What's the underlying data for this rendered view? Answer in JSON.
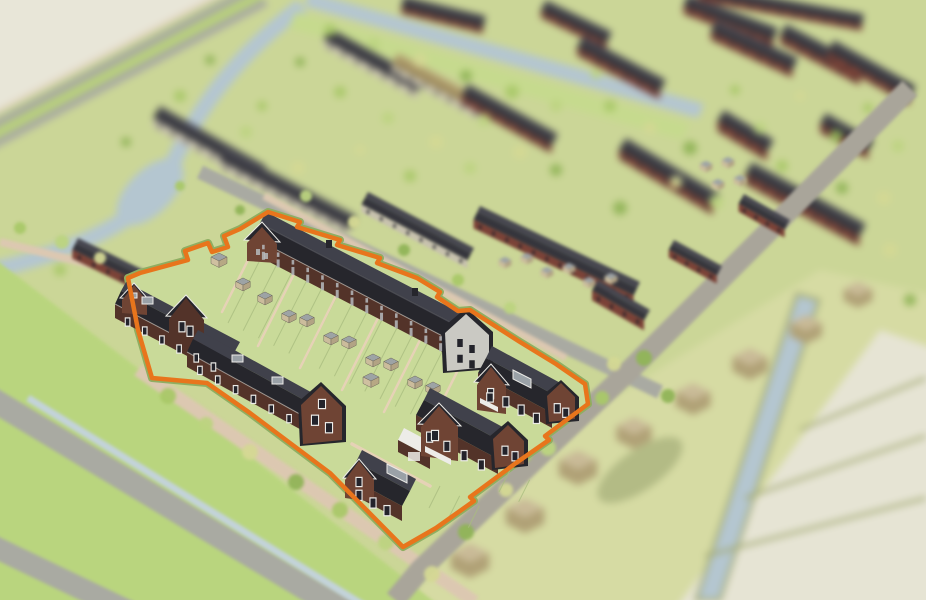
{
  "meta": {
    "title": "3D aerial visualisation of a new-build housing estate",
    "view": "isometric bird's-eye render, tilt-shift: background blurred, one building plot in focus",
    "highlight": "plot for sale outlined in orange containing terraced rows, garden sheds and detached houses"
  },
  "palette": {
    "base": "#cbd697",
    "beige": "#e8e6d8",
    "beigePolder": "#e6e4d4",
    "grassBright": "#b9d57e",
    "plotGrass": "#c9da99",
    "verge": "#b9d27b",
    "vergeDark": "#8fae62",
    "dike": "#c6da8e",
    "fieldYellow": "#d6dba3",
    "water": "#b4c6d0",
    "ditch": "#c3d3da",
    "road": "#a9aaa2",
    "roadWarm": "#a9a59a",
    "pathTan": "#dcc8b1",
    "pathPlot": "#e6d2b6",
    "orange": "#e8751c",
    "roofD": "#26262c",
    "roofL": "#40414b",
    "brick": "#533329",
    "brickB": "#6f4434",
    "stucco": "#cac9c3",
    "trim": "#edece8",
    "sky": "#9aa1a7",
    "skyD": "#737b83",
    "shedTop": "#9da3a5",
    "shedL": "#cbbc9c",
    "shedR": "#b2a384",
    "shedEdge": "#6f6a5c",
    "barn": "#c9ba97",
    "barnD": "#b0a176",
    "olive": "#a3aa74",
    "fence": "#a9bd7f",
    "win": "#23232b",
    "winL": "#b6babd",
    "shadow": "#7f8d57",
    "tree1": "#a9c868",
    "tree2": "#bcd480",
    "tree3": "#d4d894",
    "tree4": "#90b457"
  },
  "boundary": {
    "color_key": "orange",
    "stroke_width": 4.5,
    "verge_width": 8,
    "points": "268,212 300,222 297,227 340,240 337,245 380,258 377,263 417,278 440,292 437,297 458,311 470,310 520,342 556,364 585,384 588,404 545,436 549,440 516,463 470,497 474,501 436,528 403,547 330,473 250,413 207,383 152,378 138,330 128,278 140,273 188,260 185,251 208,243 212,252 228,247 224,236 240,229"
  },
  "background": {
    "rows_far": [
      [
        160,
        106,
        266,
        166,
        14,
        9,
        "light",
        "dark"
      ],
      [
        226,
        148,
        356,
        216,
        14,
        9,
        "light",
        "dark"
      ],
      [
        330,
        28,
        424,
        80,
        13,
        8,
        "light",
        "dark"
      ],
      [
        398,
        53,
        488,
        102,
        13,
        8,
        "light",
        "tanroof"
      ],
      [
        468,
        84,
        558,
        134,
        13,
        8,
        "brick",
        "dark"
      ],
      [
        404,
        -4,
        486,
        16,
        12,
        6,
        "brick",
        "dark"
      ],
      [
        546,
        0,
        612,
        32,
        12,
        7,
        "brick",
        "dark"
      ],
      [
        583,
        36,
        666,
        80,
        13,
        8,
        "brick",
        "dark"
      ],
      [
        688,
        -6,
        778,
        28,
        13,
        8,
        "brick",
        "dark"
      ],
      [
        716,
        20,
        798,
        58,
        13,
        8,
        "brick",
        "dark"
      ],
      [
        786,
        24,
        866,
        66,
        13,
        8,
        "brick",
        "dark"
      ],
      [
        834,
        40,
        916,
        86,
        13,
        8,
        "brick",
        "dark"
      ],
      [
        700,
        -16,
        864,
        14,
        11,
        6,
        "brick",
        "dark"
      ],
      [
        626,
        138,
        720,
        194,
        14,
        9,
        "brick",
        "dark"
      ],
      [
        724,
        110,
        774,
        140,
        13,
        10,
        "brick",
        "dark"
      ],
      [
        826,
        113,
        874,
        140,
        12,
        9,
        "brick",
        "dark"
      ],
      [
        752,
        162,
        866,
        224,
        14,
        10,
        "brick",
        "dark"
      ]
    ],
    "rows_near": [
      [
        368,
        192,
        474,
        248,
        14,
        8,
        "light",
        "dark"
      ],
      [
        480,
        206,
        640,
        282,
        15,
        9,
        "brick",
        "dark"
      ],
      [
        598,
        280,
        650,
        310,
        12,
        10,
        "brick",
        "dark"
      ],
      [
        674,
        240,
        722,
        266,
        11,
        8,
        "brick",
        "dark"
      ],
      [
        744,
        194,
        790,
        220,
        11,
        8,
        "brick",
        "dark"
      ],
      [
        78,
        238,
        178,
        287,
        13,
        9,
        "brick",
        "dark"
      ]
    ],
    "barns": [
      [
        470,
        565,
        24
      ],
      [
        525,
        520,
        24
      ],
      [
        578,
        472,
        24
      ],
      [
        634,
        437,
        22
      ],
      [
        693,
        403,
        22
      ],
      [
        750,
        368,
        22
      ],
      [
        806,
        333,
        20
      ],
      [
        858,
        298,
        18
      ]
    ],
    "bg_sheds": [
      [
        505,
        264
      ],
      [
        527,
        260
      ],
      [
        547,
        274
      ],
      [
        569,
        270
      ],
      [
        589,
        284
      ],
      [
        611,
        280
      ],
      [
        706,
        168
      ],
      [
        728,
        164
      ],
      [
        718,
        186
      ],
      [
        740,
        182
      ]
    ],
    "trees_far": [
      [
        180,
        96,
        6
      ],
      [
        246,
        132,
        6
      ],
      [
        298,
        168,
        7
      ],
      [
        126,
        142,
        5
      ],
      [
        340,
        92,
        6
      ],
      [
        388,
        118,
        6
      ],
      [
        436,
        142,
        7
      ],
      [
        300,
        62,
        5
      ],
      [
        262,
        106,
        5
      ],
      [
        484,
        120,
        6
      ],
      [
        520,
        152,
        7
      ],
      [
        556,
        170,
        6
      ],
      [
        610,
        106,
        6
      ],
      [
        596,
        74,
        5
      ],
      [
        650,
        128,
        6
      ],
      [
        690,
        148,
        7
      ],
      [
        735,
        90,
        5
      ],
      [
        760,
        128,
        6
      ],
      [
        800,
        96,
        5
      ],
      [
        836,
        136,
        6
      ],
      [
        868,
        108,
        5
      ],
      [
        898,
        146,
        6
      ],
      [
        884,
        198,
        7
      ],
      [
        842,
        188,
        6
      ],
      [
        782,
        166,
        6
      ],
      [
        716,
        202,
        7
      ],
      [
        676,
        182,
        6
      ],
      [
        620,
        208,
        7
      ],
      [
        410,
        176,
        6
      ],
      [
        470,
        168,
        6
      ],
      [
        360,
        150,
        5
      ],
      [
        210,
        60,
        5
      ],
      [
        60,
        270,
        6
      ],
      [
        30,
        320,
        5
      ],
      [
        890,
        250,
        7
      ],
      [
        910,
        300,
        6
      ],
      [
        330,
        30,
        6
      ],
      [
        374,
        44,
        6
      ],
      [
        420,
        60,
        7
      ],
      [
        466,
        76,
        6
      ],
      [
        512,
        92,
        7
      ],
      [
        556,
        106,
        6
      ]
    ],
    "trees_near": [
      [
        168,
        396,
        8
      ],
      [
        206,
        424,
        7
      ],
      [
        250,
        452,
        8
      ],
      [
        296,
        482,
        8
      ],
      [
        340,
        510,
        8
      ],
      [
        386,
        542,
        8
      ],
      [
        432,
        574,
        8
      ],
      [
        644,
        358,
        8
      ],
      [
        602,
        398,
        7
      ],
      [
        548,
        448,
        8
      ],
      [
        506,
        490,
        7
      ],
      [
        466,
        532,
        8
      ],
      [
        525,
        455,
        7
      ],
      [
        306,
        196,
        6
      ],
      [
        354,
        222,
        6
      ],
      [
        404,
        250,
        6
      ],
      [
        458,
        280,
        6
      ],
      [
        510,
        308,
        6
      ],
      [
        614,
        364,
        7
      ],
      [
        668,
        396,
        7
      ],
      [
        20,
        228,
        6
      ],
      [
        62,
        242,
        7
      ],
      [
        100,
        258,
        6
      ],
      [
        240,
        210,
        5
      ],
      [
        180,
        186,
        5
      ]
    ]
  },
  "plot": {
    "sheds": [
      [
        219,
        262,
        10,
        "tan"
      ],
      [
        243,
        286,
        9,
        "gray"
      ],
      [
        265,
        300,
        9,
        "gray"
      ],
      [
        289,
        318,
        9,
        "gray"
      ],
      [
        307,
        322,
        9,
        "gray"
      ],
      [
        331,
        340,
        9,
        "gray"
      ],
      [
        349,
        344,
        9,
        "gray"
      ],
      [
        373,
        362,
        9,
        "gray"
      ],
      [
        391,
        366,
        9,
        "gray"
      ],
      [
        415,
        384,
        9,
        "gray"
      ],
      [
        371,
        382,
        10,
        "tan"
      ],
      [
        433,
        390,
        9,
        "gray"
      ]
    ],
    "spur_paths": [
      [
        254,
        248,
        222,
        312
      ],
      [
        296,
        270,
        258,
        346
      ],
      [
        338,
        292,
        300,
        368
      ],
      [
        380,
        314,
        342,
        390
      ],
      [
        422,
        336,
        384,
        412
      ],
      [
        464,
        358,
        426,
        434
      ]
    ],
    "fences": [
      {
        "x": 264,
        "y": 252,
        "ux": 0.894,
        "uy": 0.447,
        "step": 17,
        "count": 13,
        "vx": -36,
        "vy": 71
      },
      {
        "x": 440,
        "y": 486,
        "ux": 0.894,
        "uy": 0.447,
        "step": 22,
        "count": 3,
        "vx": -11,
        "vy": 22
      },
      {
        "x": 510,
        "y": 470,
        "ux": 0.894,
        "uy": 0.447,
        "step": 22,
        "count": 2,
        "vx": -11,
        "vy": 22
      }
    ],
    "window_strips": [
      {
        "x1": 256,
        "y1": 241,
        "x2": 448,
        "y2": 340,
        "n": 13,
        "w": 2.6,
        "h": 4.5,
        "frame": false,
        "light": true
      },
      {
        "x1": 256,
        "y1": 248,
        "x2": 448,
        "y2": 347,
        "n": 13,
        "w": 3,
        "h": 8,
        "frame": false,
        "light": true
      },
      {
        "x1": 254,
        "y1": 247,
        "x2": 270,
        "y2": 255,
        "n": 2,
        "w": 4,
        "h": 6,
        "frame": false,
        "light": true
      },
      {
        "x1": 454,
        "y1": 336,
        "x2": 478,
        "y2": 348,
        "n": 2,
        "w": 5.5,
        "h": 8,
        "frame": false,
        "light": false
      },
      {
        "x1": 454,
        "y1": 352,
        "x2": 478,
        "y2": 363,
        "n": 2,
        "w": 5.5,
        "h": 8,
        "frame": false,
        "light": false
      },
      {
        "x1": 119,
        "y1": 314,
        "x2": 222,
        "y2": 368,
        "n": 6,
        "w": 3.5,
        "h": 7,
        "frame": true,
        "light": false
      },
      {
        "x1": 178,
        "y1": 320,
        "x2": 194,
        "y2": 329,
        "n": 2,
        "w": 5,
        "h": 9,
        "frame": true,
        "light": false
      },
      {
        "x1": 191,
        "y1": 362,
        "x2": 298,
        "y2": 420,
        "n": 6,
        "w": 3.5,
        "h": 7,
        "frame": true,
        "light": false
      },
      {
        "x1": 308,
        "y1": 412,
        "x2": 336,
        "y2": 427,
        "n": 2,
        "w": 6,
        "h": 9,
        "frame": true,
        "light": false
      },
      {
        "x1": 314,
        "y1": 396,
        "x2": 330,
        "y2": 404,
        "n": 1,
        "w": 6,
        "h": 8,
        "frame": true,
        "light": false
      },
      {
        "x1": 352,
        "y1": 487,
        "x2": 394,
        "y2": 510,
        "n": 3,
        "w": 5,
        "h": 9,
        "frame": true,
        "light": false
      },
      {
        "x1": 352,
        "y1": 474,
        "x2": 366,
        "y2": 482,
        "n": 1,
        "w": 5,
        "h": 8,
        "frame": true,
        "light": false
      },
      {
        "x1": 421,
        "y1": 428,
        "x2": 490,
        "y2": 465,
        "n": 4,
        "w": 5,
        "h": 9,
        "frame": true,
        "light": false
      },
      {
        "x1": 500,
        "y1": 444,
        "x2": 520,
        "y2": 455,
        "n": 2,
        "w": 5,
        "h": 8,
        "frame": true,
        "light": false
      },
      {
        "x1": 429,
        "y1": 428,
        "x2": 441,
        "y2": 434,
        "n": 1,
        "w": 6,
        "h": 9,
        "frame": true,
        "light": false
      },
      {
        "x1": 483,
        "y1": 385,
        "x2": 544,
        "y2": 418,
        "n": 4,
        "w": 5,
        "h": 9,
        "frame": true,
        "light": false
      },
      {
        "x1": 553,
        "y1": 402,
        "x2": 570,
        "y2": 411,
        "n": 2,
        "w": 5,
        "h": 8,
        "frame": true,
        "light": false
      },
      {
        "x1": 483,
        "y1": 390,
        "x2": 497,
        "y2": 397,
        "n": 1,
        "w": 5.5,
        "h": 8,
        "frame": true,
        "light": false
      }
    ],
    "houses": [
      "terrace-row-north",
      "terrace-row-west-a",
      "terrace-gable-junction",
      "terrace-row-west-b",
      "detached-house-south",
      "garage-flat-roof",
      "semi-detached-middle",
      "semi-detached-east"
    ]
  }
}
